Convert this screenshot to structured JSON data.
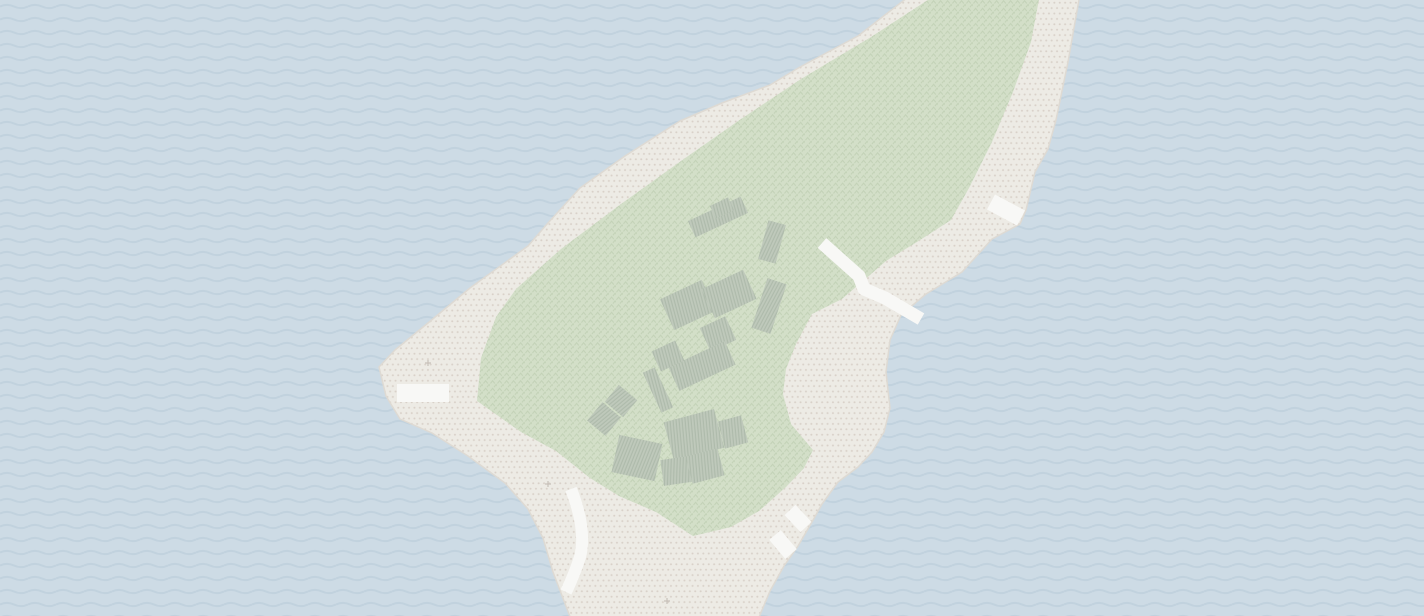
{
  "map": {
    "kind": "stylized-terrain-map",
    "description": "Textured map tile of a diagonal island: dotted beach, chevron-pattern park interior, hatched building cluster, white paths and piers, wave-pattern sea",
    "canvas": {
      "width": 1424,
      "height": 616
    },
    "colors": {
      "water_base": "#cddbe5",
      "water_wave": "#c1d2de",
      "sand_base": "#edebe5",
      "sand_dot": "#d9d1c9",
      "sand_edge": "#dedad3",
      "park_base": "#d3dfc8",
      "park_glyph": "#c3d2b7",
      "building_base": "#bfc9bb",
      "building_hatch": "#adbaaa",
      "road": "#f8f8f6",
      "sparkle": "#c8c1ba"
    },
    "patterns": {
      "wave_tile": {
        "w": 28,
        "h": 13,
        "path": "M 0 6.5 Q 7 3.2 14 6.5 T 28 6.5",
        "stroke_width": 2
      },
      "dot_tile": {
        "w": 5.4,
        "h": 10.8,
        "r": 1.0,
        "dots": [
          [
            1.35,
            2.7
          ],
          [
            4.05,
            8.1
          ]
        ]
      },
      "chevron_tile": {
        "w": 7,
        "h": 7.6,
        "path": "M 0.7 3.1 L 2.6 0.7 L 4.5 3.1",
        "offsets": [
          [
            0,
            0
          ],
          [
            3.5,
            3.8
          ]
        ],
        "stroke_width": 1
      },
      "hatch_tile": {
        "w": 3,
        "h": 9,
        "stroke_width": 1.1,
        "angle": 10
      }
    },
    "island_path": "M 912 -6 L 858 36 L 800 67 L 770 85 L 722 103 L 680 121 L 625 156 L 580 188 L 548 223 L 528 246 L 470 288 L 428 323 L 395 350 L 379 367 L 386 396 L 400 419 L 432 433 L 468 456 L 505 483 L 528 509 L 543 538 L 553 572 L 572 622 L 757 622 L 770 591 L 784 566 L 798 546 L 812 522 L 822 504 L 838 482 L 858 467 L 872 452 L 884 432 L 890 408 L 886 372 L 890 340 L 901 315 L 926 294 L 962 272 L 992 239 L 1020 224 L 1026 210 L 1035 172 L 1048 149 L 1056 120 L 1068 62 L 1080 -6 Z",
    "park_path": "M 937 -6 L 1040 -6 L 1031 42 L 1013 92 L 992 142 L 969 188 L 951 220 L 917 242 L 886 261 L 863 281 L 842 299 L 812 314 L 796 344 L 786 369 L 783 394 L 791 424 L 813 450 L 804 468 L 786 487 L 759 511 L 731 527 L 693 536 L 656 512 L 619 496 L 590 478 L 556 451 L 521 432 L 477 401 L 481 358 L 496 317 L 516 289 L 561 249 L 621 204 L 681 161 L 741 119 L 801 79 L 871 37 Z",
    "buildings": [
      {
        "cx": 718,
        "cy": 217,
        "w": 58,
        "h": 18,
        "rot": -25
      },
      {
        "cx": 722,
        "cy": 208,
        "w": 20,
        "h": 14,
        "rot": -25
      },
      {
        "cx": 772,
        "cy": 242,
        "w": 18,
        "h": 40,
        "rot": 15
      },
      {
        "cx": 688,
        "cy": 305,
        "w": 46,
        "h": 34,
        "rot": -25
      },
      {
        "cx": 729,
        "cy": 294,
        "w": 46,
        "h": 32,
        "rot": -25
      },
      {
        "cx": 769,
        "cy": 306,
        "w": 20,
        "h": 52,
        "rot": 18
      },
      {
        "cx": 718,
        "cy": 334,
        "w": 28,
        "h": 26,
        "rot": -25
      },
      {
        "cx": 702,
        "cy": 366,
        "w": 62,
        "h": 26,
        "rot": -25
      },
      {
        "cx": 668,
        "cy": 356,
        "w": 26,
        "h": 22,
        "rot": -25
      },
      {
        "cx": 621,
        "cy": 401,
        "w": 24,
        "h": 22,
        "rot": 40
      },
      {
        "cx": 604,
        "cy": 419,
        "w": 24,
        "h": 24,
        "rot": 40
      },
      {
        "cx": 637,
        "cy": 458,
        "w": 44,
        "h": 38,
        "rot": 12
      },
      {
        "cx": 658,
        "cy": 390,
        "w": 13,
        "h": 44,
        "rot": -25
      },
      {
        "cx": 694,
        "cy": 435,
        "w": 52,
        "h": 40,
        "rot": -15
      },
      {
        "cx": 733,
        "cy": 432,
        "w": 24,
        "h": 28,
        "rot": -15
      },
      {
        "cx": 676,
        "cy": 471,
        "w": 28,
        "h": 26,
        "rot": -8
      },
      {
        "cx": 705,
        "cy": 466,
        "w": 33,
        "h": 28,
        "rot": -15
      }
    ],
    "roads": [
      {
        "name": "west-shore-path",
        "path": "M 397 393 L 449 393",
        "width": 18
      },
      {
        "name": "central-shore-road",
        "path": "M 822 243 L 859 276 L 864 289 L 885 298 L 921 319",
        "width": 13
      },
      {
        "name": "northeast-pier",
        "path": "M 991 202 L 1021 218",
        "width": 17
      },
      {
        "name": "southwest-curved-path",
        "path": "M 571 489 Q 587 530 580 557 Q 575 573 566 592",
        "width": 12
      },
      {
        "name": "southeast-pier-upper",
        "path": "M 790 510 L 806 527",
        "width": 15
      },
      {
        "name": "southeast-pier-lower",
        "path": "M 775 535 L 791 554",
        "width": 15
      }
    ],
    "sparkles": [
      {
        "x": 428,
        "y": 363
      },
      {
        "x": 548,
        "y": 484
      },
      {
        "x": 667,
        "y": 601
      }
    ]
  }
}
